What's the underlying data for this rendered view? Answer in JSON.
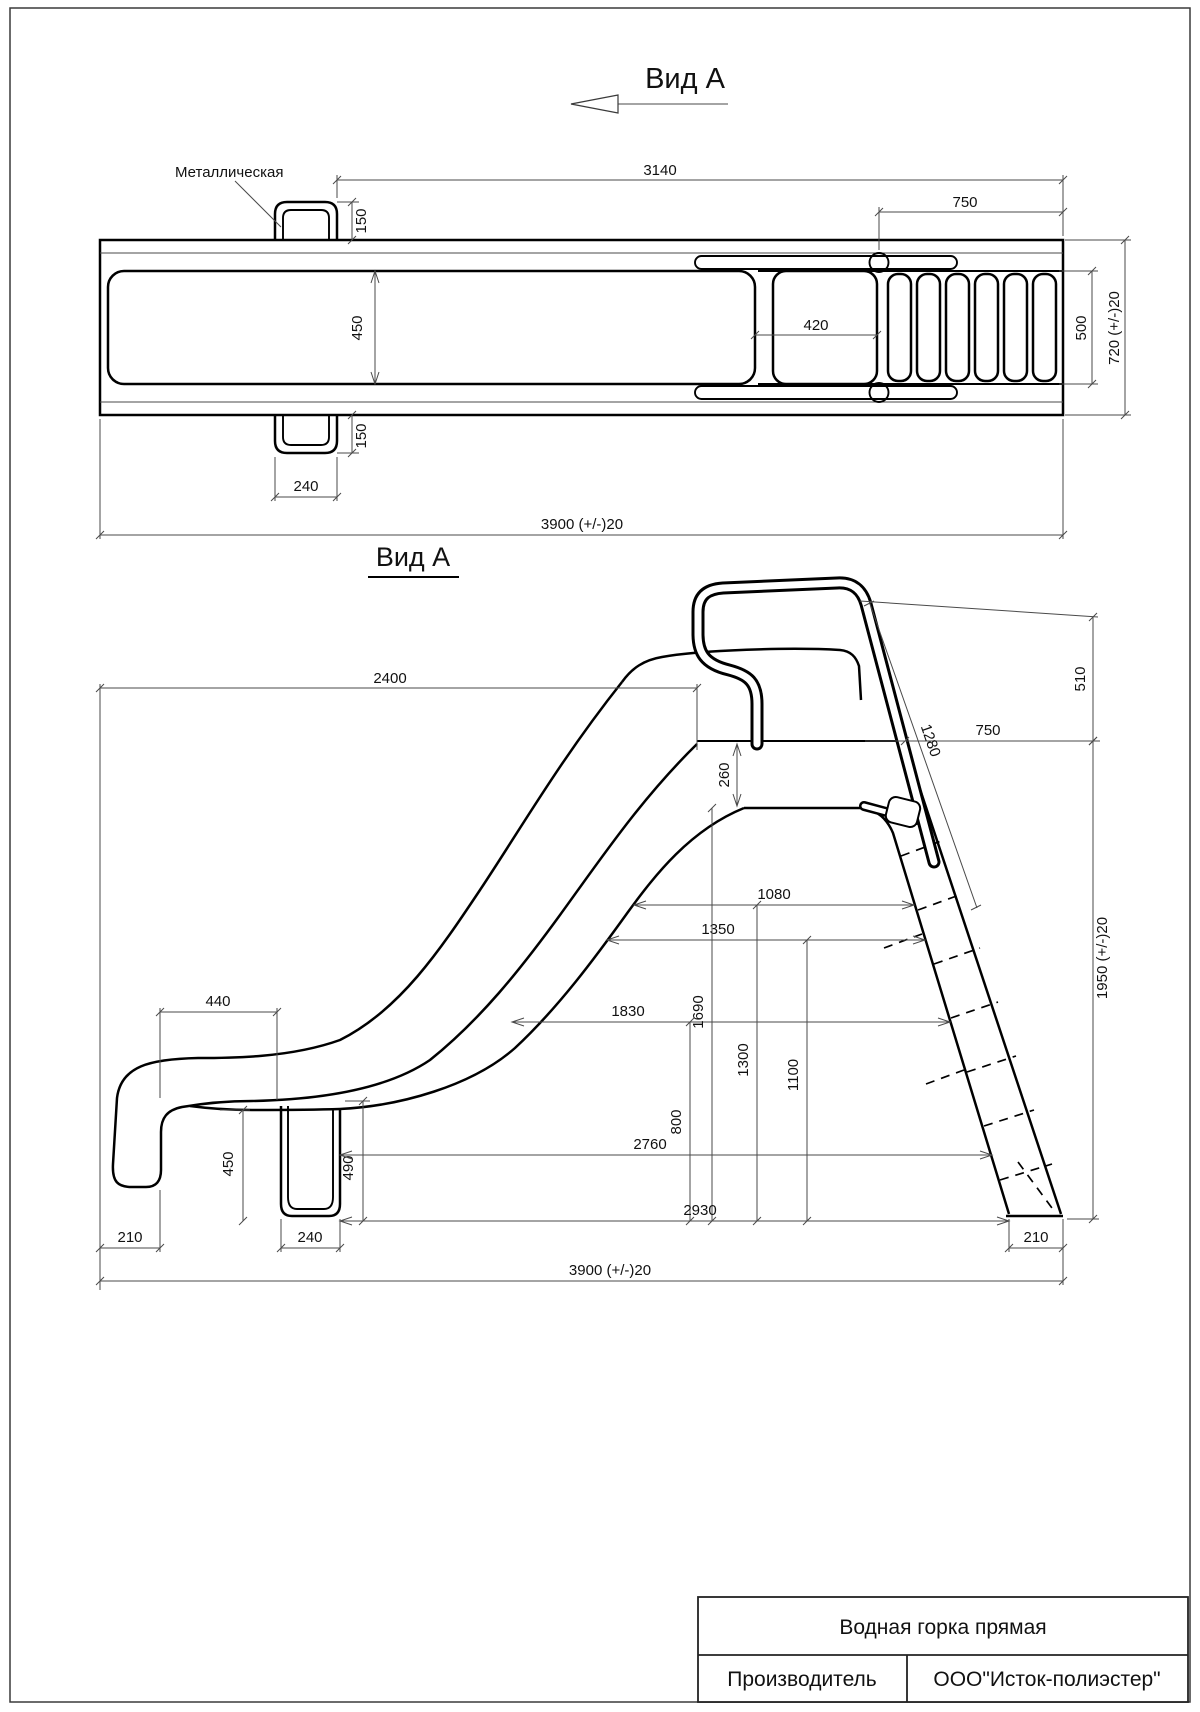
{
  "view_top": {
    "arrow_title": "Вид А",
    "material_label": "Металлическая",
    "dims": {
      "length_to_ladder": "3140",
      "ladder_section": "750",
      "handle_offset_top": "150",
      "handle_offset_bottom": "150",
      "flume_width": "450",
      "platform_length": "420",
      "handle_width": "240",
      "overall_length": "3900 (+/-)20",
      "ladder_width": "500",
      "overall_width": "720 (+/-)20"
    }
  },
  "view_side": {
    "title": "Вид А",
    "dims": {
      "slide_horizontal": "2400",
      "deck_to_frame": "260",
      "deck_to_rail_top_span": "750",
      "rail_above_deck": "510",
      "rail_length": "1280",
      "span_1080": "1080",
      "span_1350": "1350",
      "span_1830": "1830",
      "height_1690": "1690",
      "height_1300": "1300",
      "height_1100": "1100",
      "height_800": "800",
      "exit_lip_span": "440",
      "leg_height": "450",
      "deck_height_at_leg": "490",
      "span_2760": "2760",
      "span_2930": "2930",
      "left_margin": "210",
      "leg_width": "240",
      "foot_width": "210",
      "overall_length": "3900 (+/-)20",
      "overall_height": "1950 (+/-)20"
    }
  },
  "title_block": {
    "product": "Водная горка прямая",
    "manufacturer_label": "Производитель",
    "manufacturer": "ООО\"Исток-полиэстер\""
  }
}
